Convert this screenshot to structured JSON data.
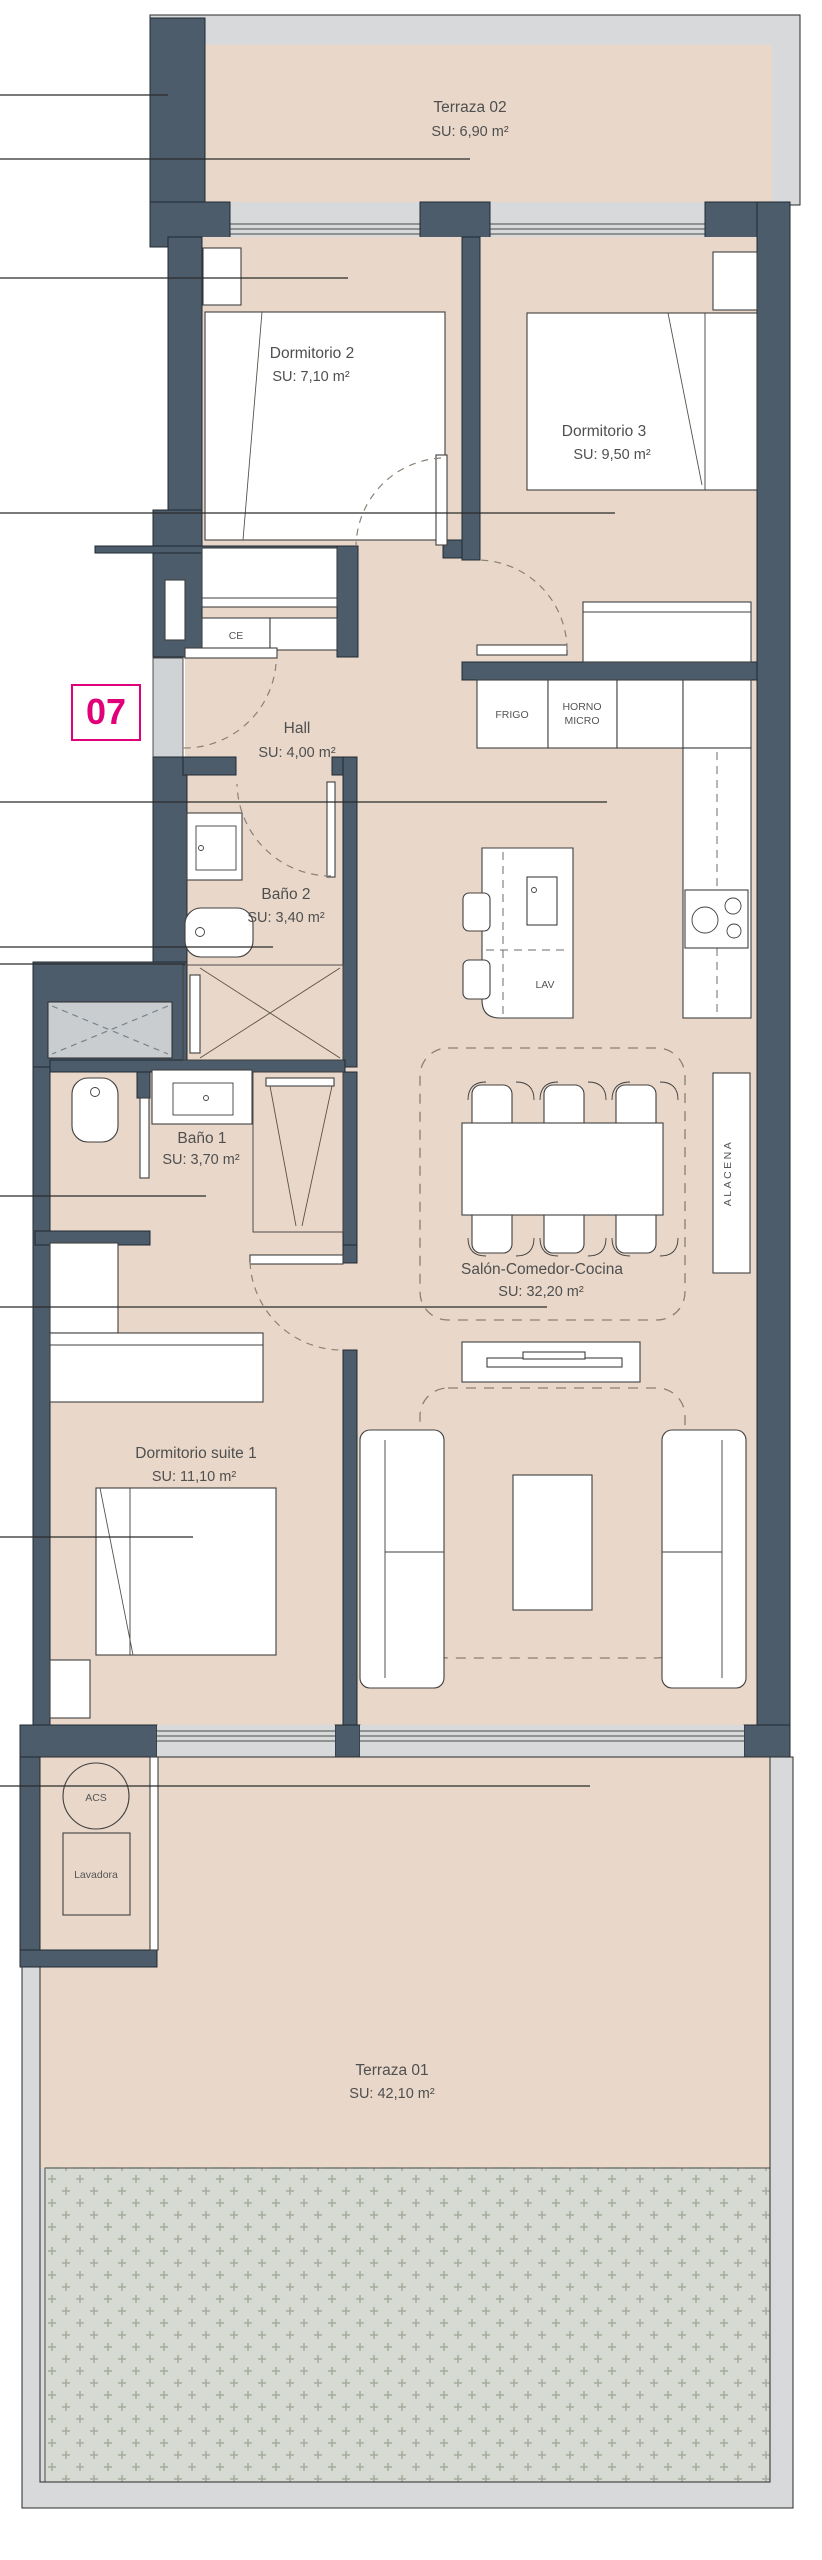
{
  "unit": {
    "number": "07"
  },
  "rooms": {
    "terraza02": {
      "name": "Terraza 02",
      "area": "SU: 6,90 m²"
    },
    "dormitorio2": {
      "name": "Dormitorio 2",
      "area": "SU: 7,10 m²"
    },
    "dormitorio3": {
      "name": "Dormitorio 3",
      "area": "SU: 9,50 m²"
    },
    "hall": {
      "name": "Hall",
      "area": "SU: 4,00 m²"
    },
    "bano2": {
      "name": "Baño 2",
      "area": "SU: 3,40 m²"
    },
    "bano1": {
      "name": "Baño 1",
      "area": "SU: 3,70 m²"
    },
    "salon": {
      "name": "Salón-Comedor-Cocina",
      "area": "SU: 32,20 m²"
    },
    "suite": {
      "name": "Dormitorio suite 1",
      "area": "SU: 11,10 m²"
    },
    "terraza01": {
      "name": "Terraza 01",
      "area": "SU: 42,10 m²"
    }
  },
  "fixtures": {
    "ce": "CE",
    "frigo": "FRIGO",
    "horno_micro": [
      "HORNO",
      "MICRO"
    ],
    "lav": "LAV",
    "alacena": "ALACENA",
    "acs": "ACS",
    "lavadora": "Lavadora"
  },
  "colors": {
    "wall": "#4d5c6a",
    "floor": "#e9d8ca",
    "glass": "#d7d9db",
    "gravel_bg": "#d6dad3",
    "gravel_mark": "#a3ac9d",
    "accent": "#e0007a",
    "text": "#4f4f4f"
  }
}
